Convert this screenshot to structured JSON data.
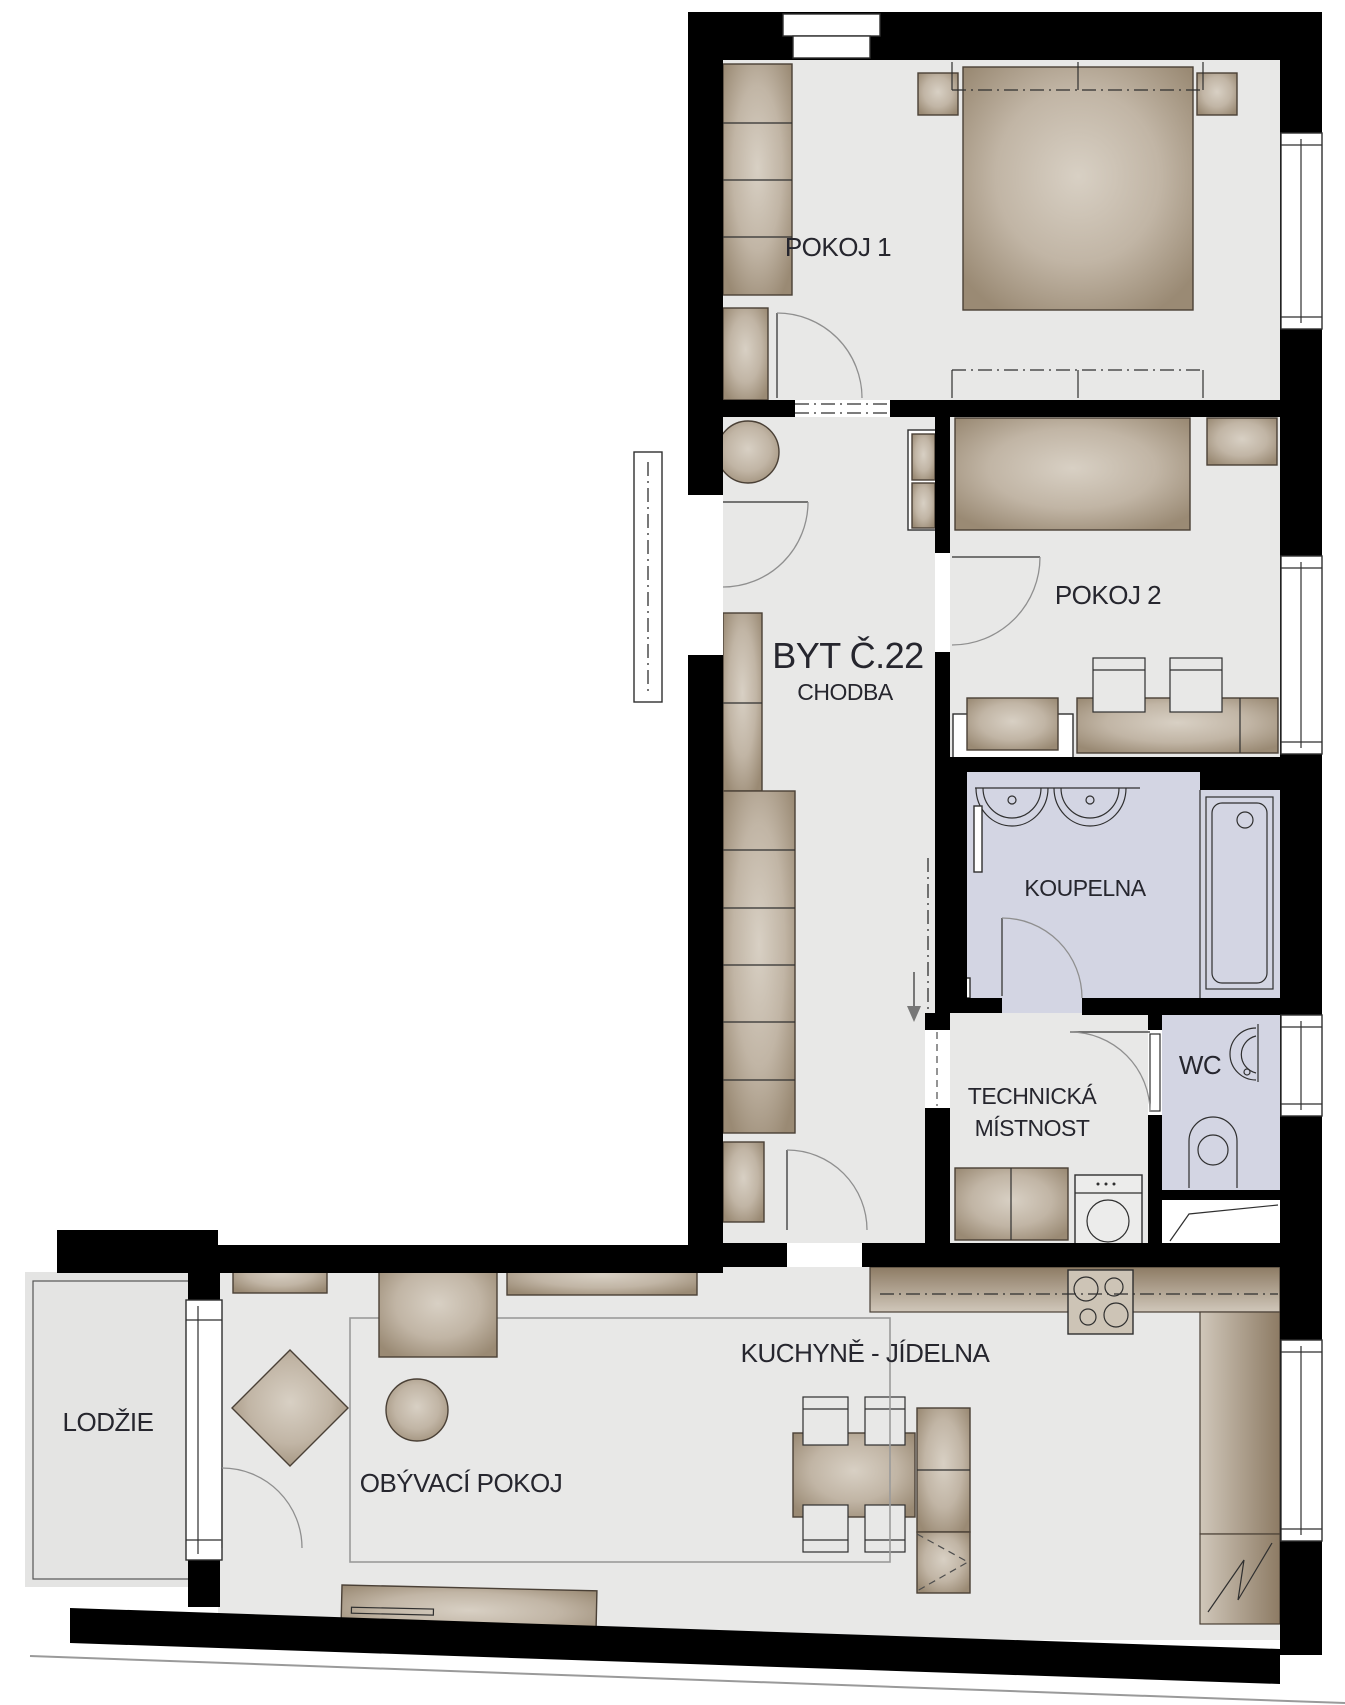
{
  "labels": {
    "apartment": "BYT Č.22",
    "hallway": "CHODBA",
    "room1": "POKOJ 1",
    "room2": "POKOJ 2",
    "bathroom": "KOUPELNA",
    "wc": "WC",
    "technical_line1": "TECHNICKÁ",
    "technical_line2": "MÍSTNOST",
    "kitchen": "KUCHYNĚ - JÍDELNA",
    "living": "OBÝVACÍ POKOJ",
    "loggia": "LODŽIE"
  },
  "colors": {
    "wall": "#000000",
    "floor": "#e8e8e7",
    "wet-floor": "#d3d5e3",
    "loggia-floor": "#e4e4e3",
    "furniture-dark": "#9a8a74",
    "furniture-light": "#d8d0c4",
    "door-arc": "#8f8f8f",
    "label": "#26262e"
  }
}
